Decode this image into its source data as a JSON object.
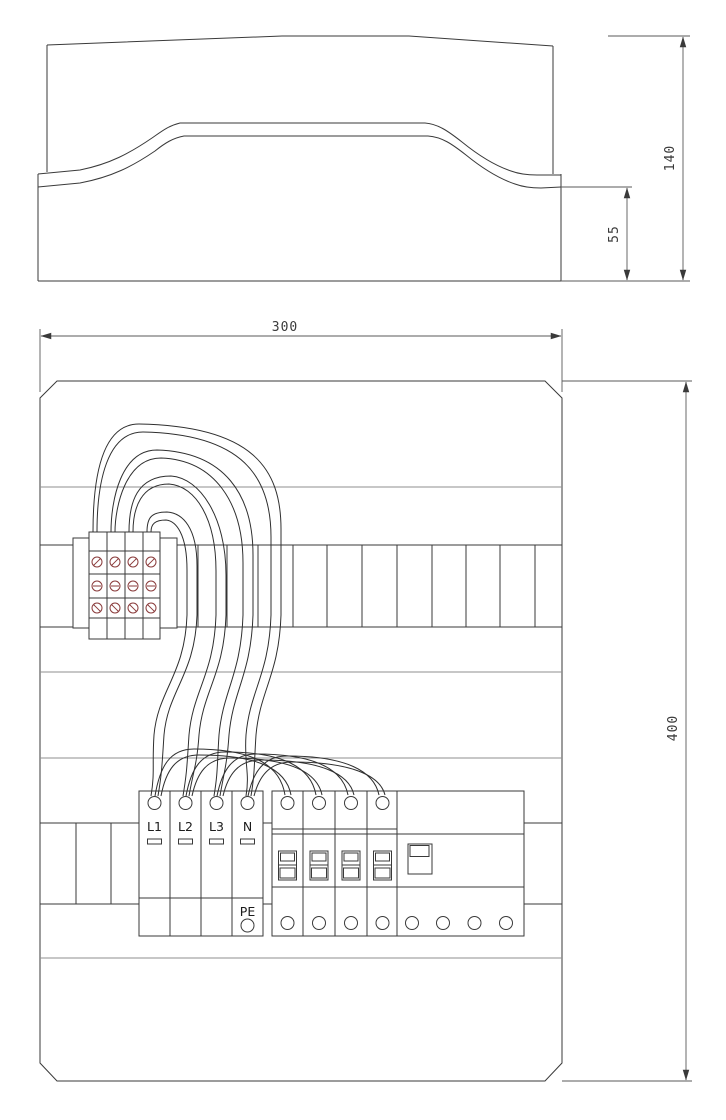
{
  "drawing": {
    "title": "enclosure-technical-drawing",
    "side_view": {
      "dim_height": "140",
      "dim_base_height": "55"
    },
    "front_view": {
      "dim_width": "300",
      "dim_height": "400",
      "spd_block": {
        "modules": [
          {
            "label": "L1"
          },
          {
            "label": "L2"
          },
          {
            "label": "L3"
          },
          {
            "label": "N"
          }
        ],
        "pe_label": "PE"
      }
    },
    "colors": {
      "line": "#3a3a3a",
      "light_line": "#8f8f8f",
      "screw_terminal": "#8a3b3b",
      "wire": "#2f2f2f",
      "background": "#ffffff"
    }
  }
}
